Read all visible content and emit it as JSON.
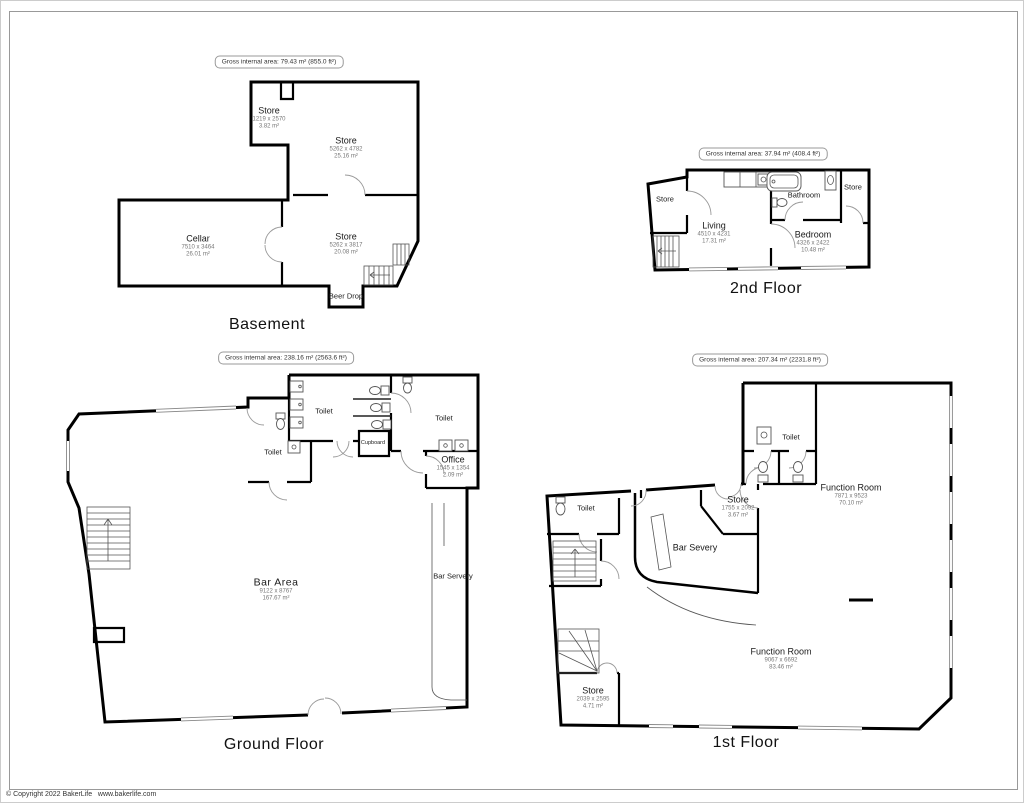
{
  "page": {
    "copyright": "© Copyright 2022 BakerLife   www.bakerlife.com"
  },
  "floors": [
    {
      "title": "Basement",
      "gross_area": "Gross internal area: 79.43 m² (855.0 ft²)",
      "rooms": [
        {
          "name": "Store",
          "dims": "1219 x 2570",
          "area": "3.82 m²"
        },
        {
          "name": "Store",
          "dims": "5262 x 4782",
          "area": "25.16 m²"
        },
        {
          "name": "Cellar",
          "dims": "7510 x 3464",
          "area": "26.01 m²"
        },
        {
          "name": "Store",
          "dims": "5262 x 3817",
          "area": "20.08 m²"
        },
        {
          "name": "Beer Drop"
        }
      ]
    },
    {
      "title": "2nd Floor",
      "gross_area": "Gross internal area: 37.94 m² (408.4 ft²)",
      "rooms": [
        {
          "name": "Store"
        },
        {
          "name": "Living",
          "dims": "4510 x 4231",
          "area": "17.31 m²"
        },
        {
          "name": "Bathroom"
        },
        {
          "name": "Store"
        },
        {
          "name": "Bedroom",
          "dims": "4326 x 2422",
          "area": "10.48 m²"
        }
      ]
    },
    {
      "title": "Ground Floor",
      "gross_area": "Gross internal area: 238.16 m² (2563.6 ft²)",
      "rooms": [
        {
          "name": "Toilet"
        },
        {
          "name": "Toilet"
        },
        {
          "name": "Toilet"
        },
        {
          "name": "Cupboard"
        },
        {
          "name": "Office",
          "dims": "1545 x 1354",
          "area": "2.09 m²"
        },
        {
          "name": "Bar Area",
          "dims": "9122 x 8767",
          "area": "167.67 m²"
        },
        {
          "name": "Bar Servery"
        }
      ]
    },
    {
      "title": "1st Floor",
      "gross_area": "Gross internal area: 207.34 m² (2231.8 ft²)",
      "rooms": [
        {
          "name": "Toilet"
        },
        {
          "name": "Toilet"
        },
        {
          "name": "Store",
          "dims": "1755 x 2092",
          "area": "3.67 m²"
        },
        {
          "name": "Bar Severy"
        },
        {
          "name": "Function Room",
          "dims": "7871 x 9523",
          "area": "70.10 m²"
        },
        {
          "name": "Function Room",
          "dims": "9067 x 6692",
          "area": "83.46 m²"
        },
        {
          "name": "Store",
          "dims": "2039 x 2595",
          "area": "4.71 m²"
        }
      ]
    }
  ]
}
